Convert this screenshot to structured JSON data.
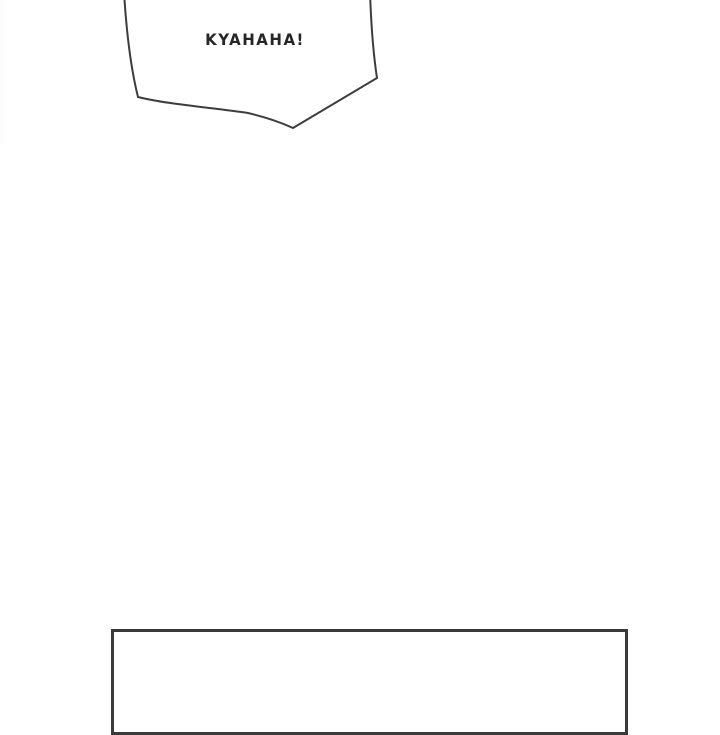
{
  "page": {
    "background_color": "#ffffff",
    "line_color": "#3d3d3f",
    "text_color": "#262626"
  },
  "speech_bubble": {
    "text": "KYAHAHA!"
  },
  "next_panel": {
    "border_color": "#3a3a3c"
  }
}
